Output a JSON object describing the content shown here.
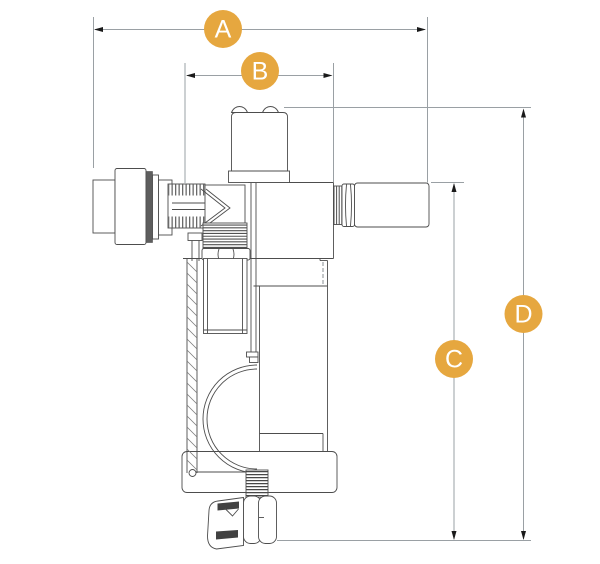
{
  "diagram": {
    "description": "Technical cross-section line drawing of a valve assembly with four dimension callouts",
    "markers": [
      {
        "label": "A",
        "orientation": "horizontal"
      },
      {
        "label": "B",
        "orientation": "horizontal"
      },
      {
        "label": "C",
        "orientation": "vertical"
      },
      {
        "label": "D",
        "orientation": "vertical"
      }
    ],
    "marker_style": {
      "fill": "#E6A73F",
      "text_color": "#FFFFFF"
    },
    "line_colors": {
      "dimension": "#9AA0A4",
      "drawing": "#4D4D4D",
      "arrowhead": "#1A1A1A"
    },
    "background": "#FFFFFF"
  }
}
